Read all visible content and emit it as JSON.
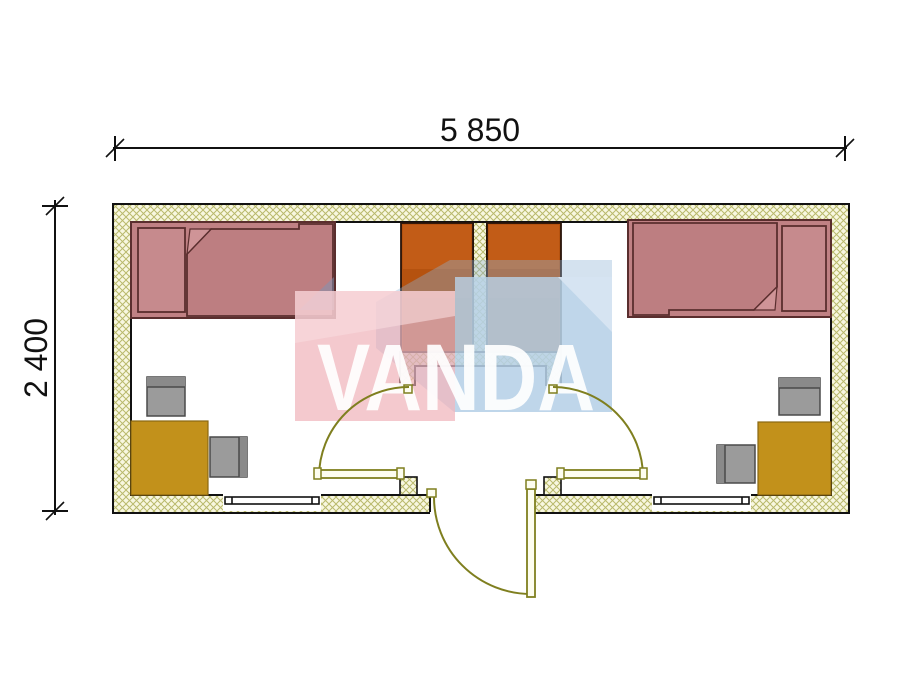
{
  "watermark": {
    "text": "VANDA",
    "pink": "#efadb4",
    "pink_light": "#f9dcdf",
    "blue": "#b9d3e9",
    "blue_light": "#d8e6f3"
  },
  "dimensions": {
    "width": "5 850",
    "height": "2 400"
  },
  "colors": {
    "outline": "#111111",
    "wall_fill": "#f8f7e0",
    "wall_hatch": "#b9b96c",
    "bed": "#c08184",
    "bed_outline": "#5a2e2e",
    "pillow": "#c68a8d",
    "blanket": "#bd7e81",
    "fold": "#cf9497",
    "wardrobe": "#b5520f",
    "wardrobe_top": "#c25c17",
    "desk": "#c2911b",
    "chair": "#9b9b9b",
    "chair_dark": "#8a8a8a",
    "door": "#7f7f1f",
    "door_fill": "#fdfdef"
  },
  "plan": {
    "kind": "cabin-floor-plan",
    "rooms": [
      "left-bedroom",
      "entry-vestibule",
      "right-bedroom"
    ],
    "furniture_left_room": [
      "bed",
      "pillow",
      "wardrobe",
      "desk",
      "chair",
      "chair"
    ],
    "furniture_right_room": [
      "bed",
      "pillow",
      "wardrobe",
      "desk",
      "chair",
      "chair"
    ],
    "openings": [
      "entrance-door",
      "left-room-door",
      "right-room-door",
      "left-window",
      "right-window"
    ]
  }
}
